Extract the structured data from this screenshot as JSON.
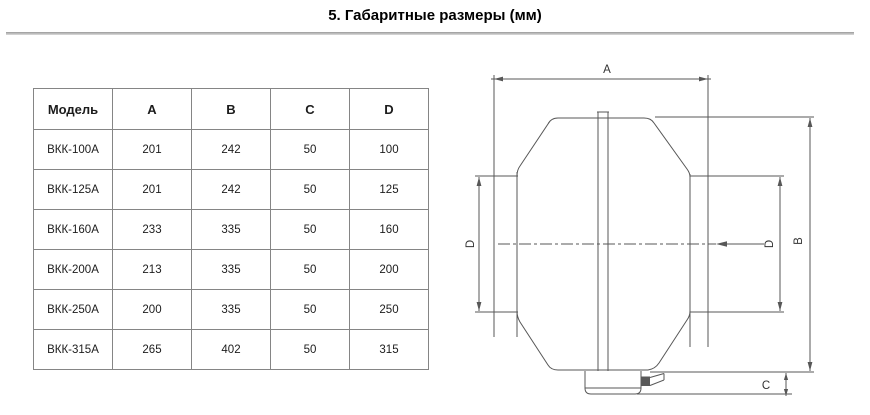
{
  "page": {
    "title": "5. Габаритные размеры (мм)"
  },
  "table": {
    "headers": [
      "Модель",
      "A",
      "B",
      "C",
      "D"
    ],
    "rows": [
      [
        "ВКК-100А",
        "201",
        "242",
        "50",
        "100"
      ],
      [
        "ВКК-125А",
        "201",
        "242",
        "50",
        "125"
      ],
      [
        "ВКК-160А",
        "233",
        "335",
        "50",
        "160"
      ],
      [
        "ВКК-200А",
        "213",
        "335",
        "50",
        "200"
      ],
      [
        "ВКК-250А",
        "200",
        "335",
        "50",
        "250"
      ],
      [
        "ВКК-315А",
        "265",
        "402",
        "50",
        "315"
      ]
    ]
  },
  "diagram": {
    "labels": {
      "a": "A",
      "b": "B",
      "c": "C",
      "d_left": "D",
      "d_right": "D"
    },
    "colors": {
      "line": "#575757",
      "table_border": "#858585",
      "divider": "#9a9a9a",
      "text": "#1c1c1c"
    }
  }
}
